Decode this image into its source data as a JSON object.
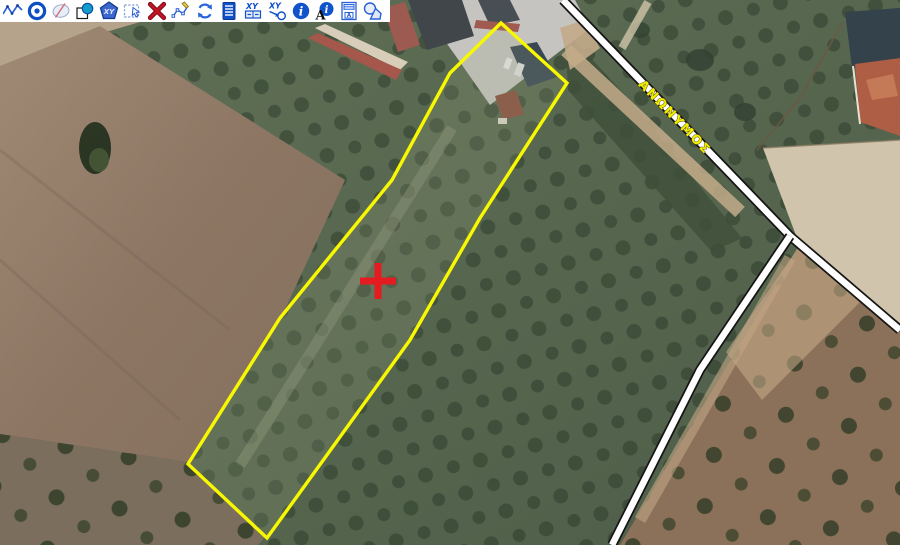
{
  "app": {
    "type": "gis-map-viewer"
  },
  "toolbar": {
    "background": "#ffffff",
    "glyphs": {
      "xy": "XY",
      "xy2": "XY",
      "xy3": "XY",
      "i": "i",
      "i2": "i",
      "a": "A",
      "form_a": "A"
    },
    "buttons": [
      {
        "id": "draw-polyline"
      },
      {
        "id": "draw-circle-center"
      },
      {
        "id": "draw-ellipse"
      },
      {
        "id": "draw-square-circle"
      },
      {
        "id": "polygon-from-xy"
      },
      {
        "id": "select-feature"
      },
      {
        "id": "delete-feature"
      },
      {
        "id": "edit-vertices"
      },
      {
        "id": "refresh-view"
      },
      {
        "id": "attribute-list"
      },
      {
        "id": "xy-coordinate-table"
      },
      {
        "id": "goto-xy"
      },
      {
        "id": "identify"
      },
      {
        "id": "identify-attributes"
      },
      {
        "id": "label-form"
      },
      {
        "id": "geometry-shapes"
      }
    ]
  },
  "map": {
    "road_label": "ΑΝΩΝΥΜΟΣ",
    "road_label_color": "#f2ee00",
    "parcel": {
      "points": "501,23 567,83 480,218 410,340 267,538 188,464 280,318 392,180 450,73",
      "outline_color": "#f8f800"
    },
    "marker": {
      "transform": "translate(378,281)",
      "color": "#e41b20"
    }
  }
}
